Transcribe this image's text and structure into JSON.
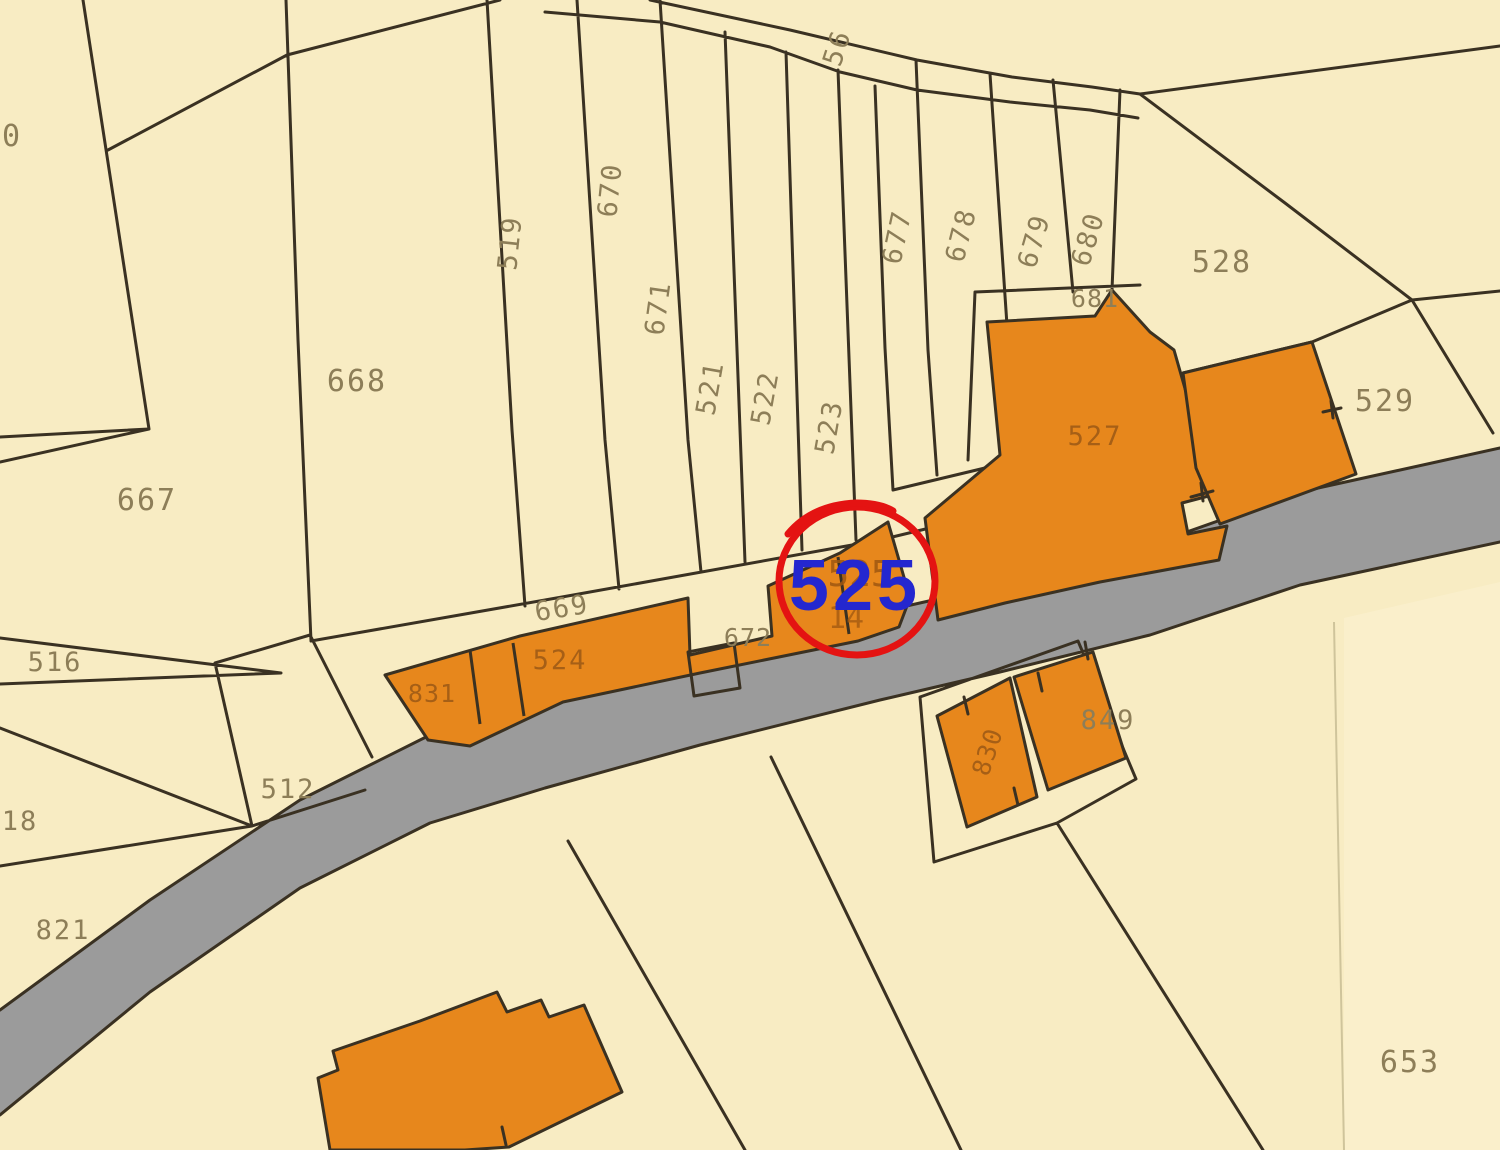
{
  "map_title": "cadastral-parcel-map",
  "annotation": {
    "circled_parcel": "525",
    "under_text": "525",
    "under_text2": "14"
  },
  "labels": {
    "l510": "510",
    "l668": "668",
    "l667": "667",
    "l519": "519",
    "l670": "670",
    "l671": "671",
    "l521": "521",
    "l522": "522",
    "l523": "523",
    "l56": "56",
    "l677": "677",
    "l678": "678",
    "l679": "679",
    "l680": "680",
    "l681": "681",
    "l528": "528",
    "l529": "529",
    "l527": "527",
    "l669": "669",
    "l524": "524",
    "l831": "831",
    "l672": "672",
    "l516": "516",
    "l512": "512",
    "l18": "18",
    "l821": "821",
    "l830": "830",
    "l849": "849",
    "l653": "653"
  },
  "colors": {
    "background": "#f8ecc3",
    "background_light": "#fbf2d2",
    "parcel_line": "#3a3122",
    "label": "#8d7e58",
    "label_on_orange": "#a65f16",
    "label_under_circle": "#9f5711",
    "orange": "#e7871c",
    "road": "#9b9b9b",
    "light_boundary": "#cfc49b",
    "highlight_red": "#e41312",
    "highlight_blue": "#2427cf"
  }
}
